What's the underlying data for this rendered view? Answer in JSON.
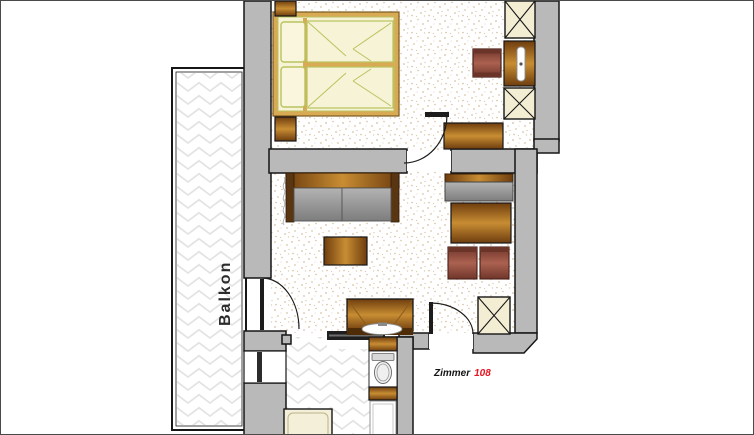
{
  "labels": {
    "balcony": "Balkon",
    "room": "Zimmer",
    "room_number": "108"
  },
  "colors": {
    "wall": "#b9b9b9",
    "outline": "#161616",
    "cream": "#f3edd3",
    "wood_dark": "#6e3d0e",
    "wood_light": "#c88d33",
    "bed_frame": "#d9aa54",
    "linen": "#f6f3d6",
    "linen_line": "#b9c35f",
    "tile_line": "#e3e3e3",
    "accent_red": "#e81420",
    "label_dark": "#2b2b2b"
  }
}
